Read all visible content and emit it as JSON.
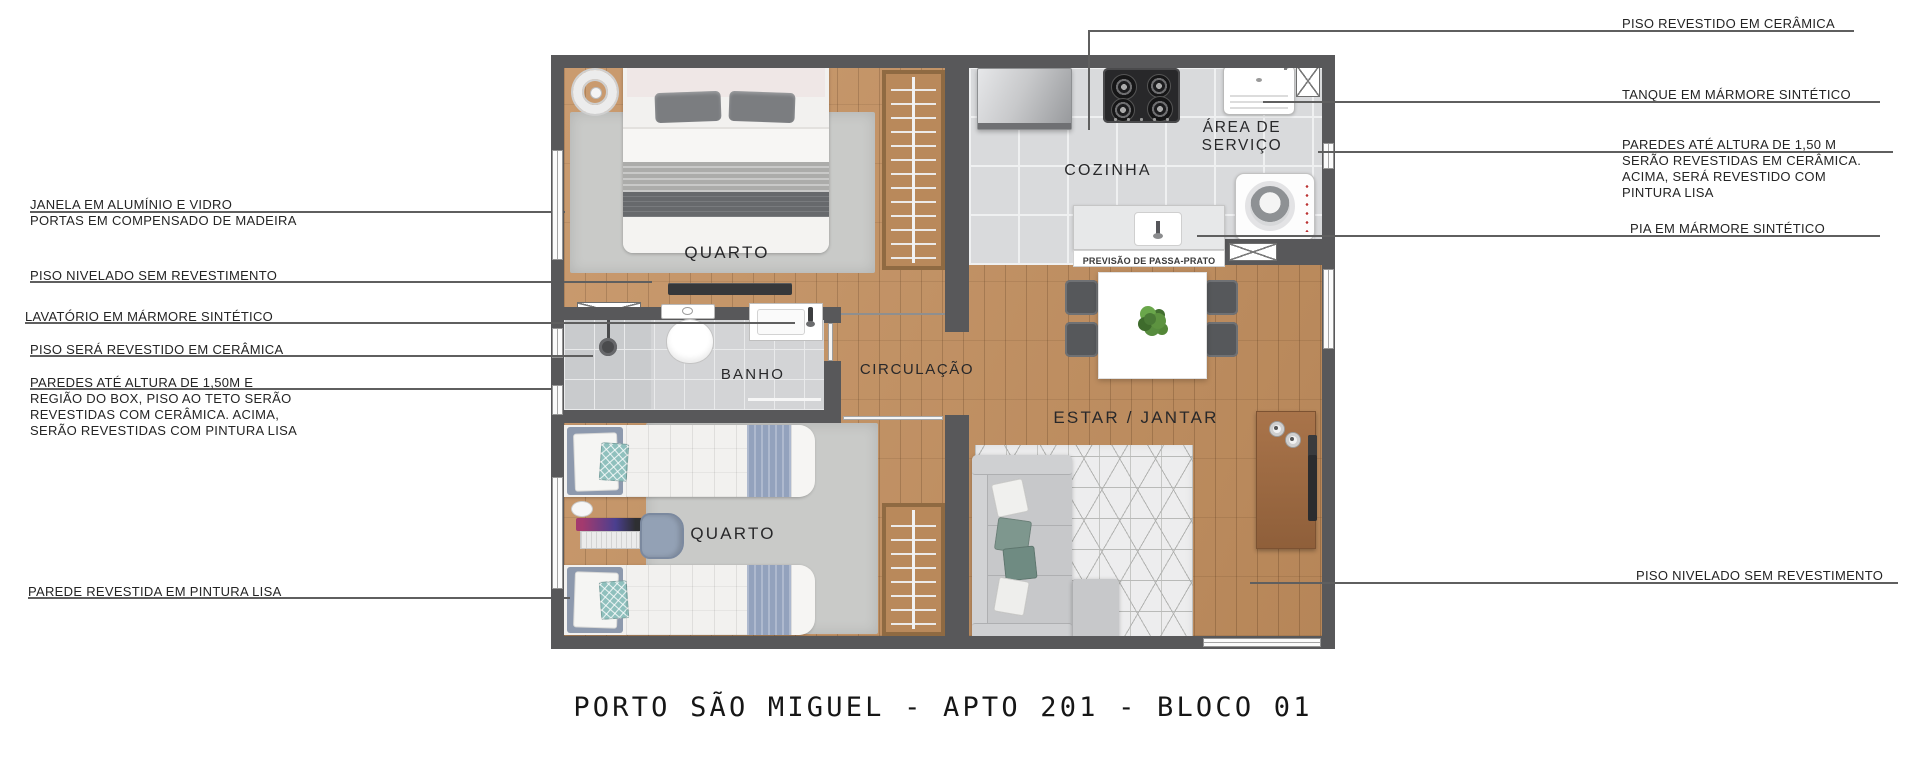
{
  "title": "PORTO SÃO MIGUEL - APTO 201 - BLOCO 01",
  "rooms": {
    "bedroom1": "QUARTO",
    "bedroom2": "QUARTO",
    "bathroom": "BANHO",
    "circulation": "CIRCULAÇÃO",
    "kitchen": "COZINHA",
    "service_line1": "ÁREA DE",
    "service_line2": "SERVIÇO",
    "living": "ESTAR / JANTAR",
    "passa_prato": "PREVISÃO DE PASSA-PRATO"
  },
  "callouts_left": [
    {
      "lines": [
        "JANELA EM ALUMÍNIO E VIDRO",
        "PORTAS EM COMPENSADO DE MADEIRA"
      ]
    },
    {
      "lines": [
        "PISO NIVELADO SEM REVESTIMENTO"
      ]
    },
    {
      "lines": [
        "LAVATÓRIO EM MÁRMORE SINTÉTICO"
      ]
    },
    {
      "lines": [
        "PISO SERÁ REVESTIDO EM CERÂMICA"
      ]
    },
    {
      "lines": [
        "PAREDES ATÉ ALTURA DE 1,50M E",
        "REGIÃO DO BOX, PISO AO TETO SERÃO",
        "REVESTIDAS COM CERÂMICA. ACIMA,",
        "SERÃO REVESTIDAS COM PINTURA LISA"
      ]
    },
    {
      "lines": [
        "PAREDE REVESTIDA EM PINTURA LISA"
      ]
    }
  ],
  "callouts_right": [
    {
      "lines": [
        "PISO REVESTIDO EM CERÂMICA"
      ]
    },
    {
      "lines": [
        "TANQUE EM MÁRMORE SINTÉTICO"
      ]
    },
    {
      "lines": [
        "PAREDES ATÉ ALTURA DE 1,50 M",
        "SERÃO REVESTIDAS EM CERÂMICA.",
        "ACIMA, SERÁ REVESTIDO COM",
        "PINTURA LISA"
      ]
    },
    {
      "lines": [
        "PIA EM MÁRMORE SINTÉTICO"
      ]
    },
    {
      "lines": [
        "PISO NIVELADO SEM REVESTIMENTO"
      ]
    }
  ],
  "colors": {
    "wall": "#58585a",
    "wood_floor": "#c4905f",
    "ceramic_tile": "#d9dadc",
    "rug_gray": "#c9cac8",
    "blanket_blue": "#93a2bd",
    "cushion_teal": "#7e978e"
  }
}
